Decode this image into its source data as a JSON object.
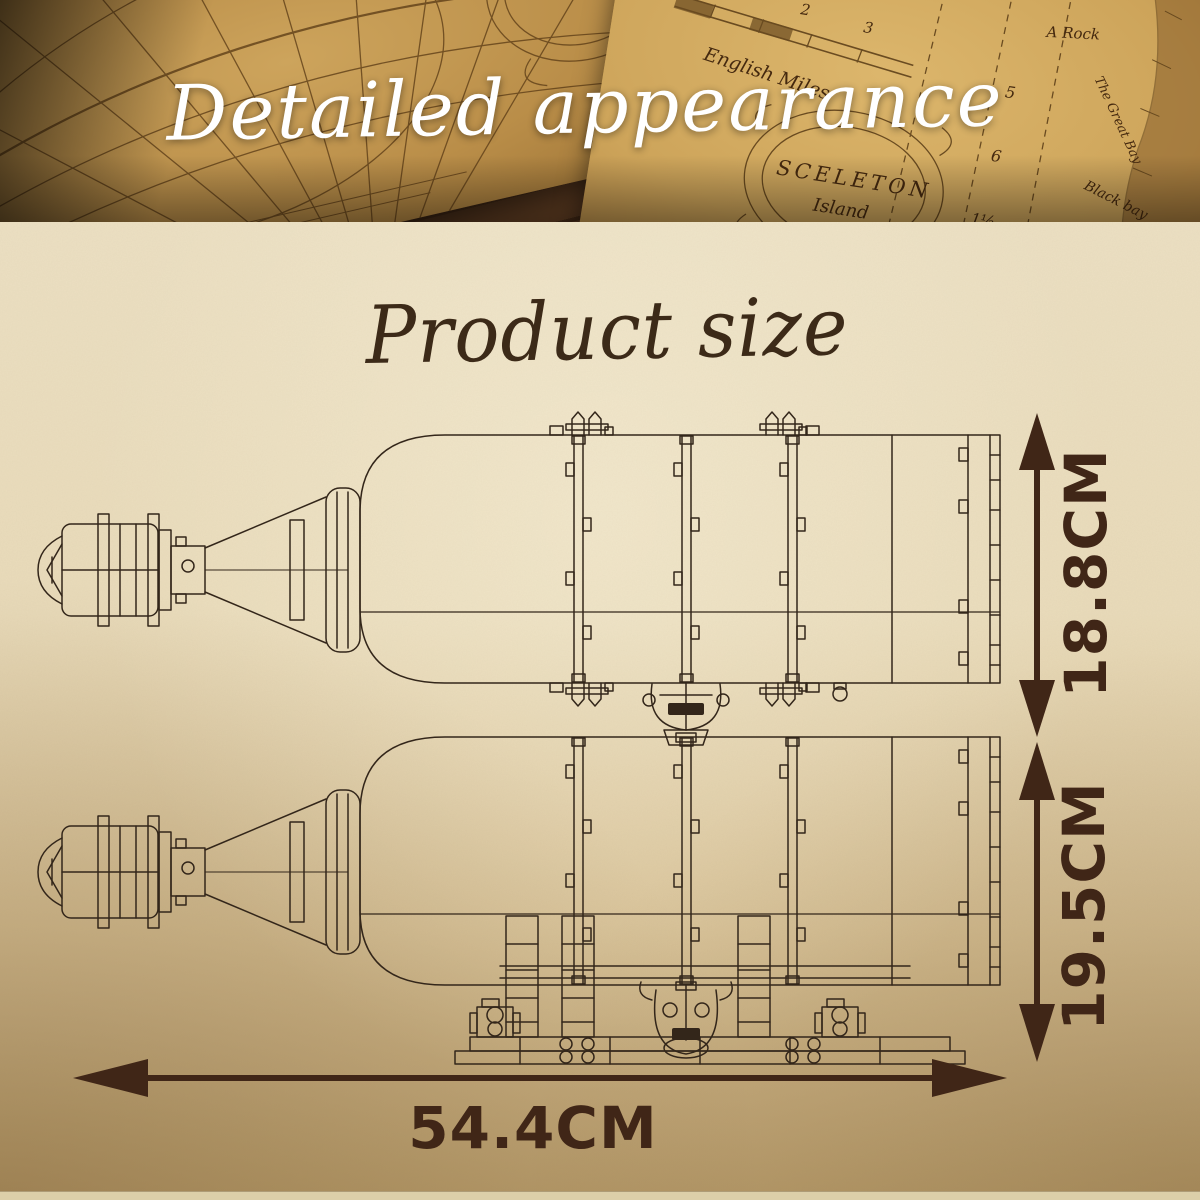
{
  "banner": {
    "title": "Detailed appearance",
    "left_map": {
      "cartouche_label": "Minium"
    },
    "right_map": {
      "island_name_line1": "SCELETON",
      "island_name_line2": "Island",
      "scale_label": "English Miles",
      "scale_numbers": [
        "1",
        "2",
        "3"
      ],
      "depth_numbers": [
        "4",
        "5",
        "6",
        "1½"
      ],
      "label_rock": "A Rock",
      "label_great_bay": "The Great Bay",
      "label_black_bay": "Black bay"
    }
  },
  "size_section": {
    "title": "Product size",
    "dimensions": {
      "bottle_height": "18.8CM",
      "total_height": "19.5CM",
      "length": "54.4CM"
    }
  },
  "colors": {
    "dimension_marks": "#402617",
    "line_art": "#33261a",
    "title_text": "#3c2a18",
    "banner_text": "#ffffff",
    "parchment_top": "#ece0c3",
    "parchment_bottom": "#b79b6a",
    "map_label_ink": "#4a2c12"
  }
}
